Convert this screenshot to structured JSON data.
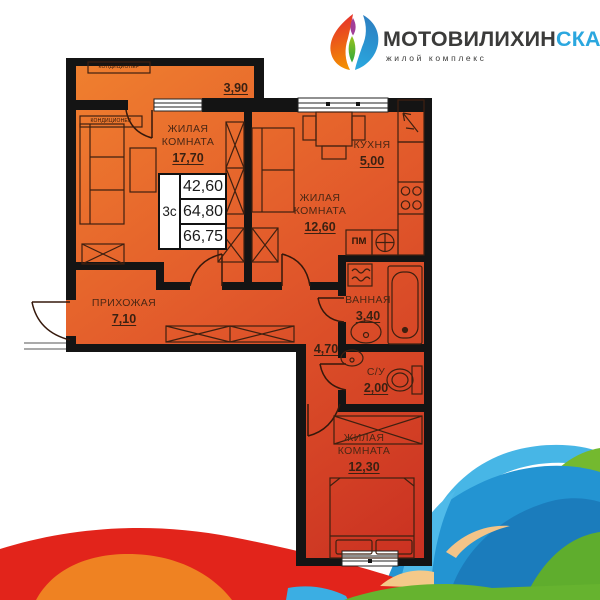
{
  "logo": {
    "brand_main": "МОТОВИЛИХИН",
    "brand_accent": "СКАЙ",
    "tagline": "жилой комплекс",
    "accent_color": "#2ba7df"
  },
  "plan": {
    "apartment_type": "3с",
    "areas": {
      "living": "42,60",
      "total": "64,80",
      "total_with_balcony": "66,75"
    },
    "rooms": [
      {
        "id": "balcony",
        "label": "",
        "area": "3,90"
      },
      {
        "id": "living-room-1",
        "label": "ЖИЛАЯ КОМНАТА",
        "area": "17,70"
      },
      {
        "id": "living-room-2",
        "label": "ЖИЛАЯ КОМНАТА",
        "area": "12,60"
      },
      {
        "id": "kitchen",
        "label": "КУХНЯ",
        "area": "5,00"
      },
      {
        "id": "hallway",
        "label": "ПРИХОЖАЯ",
        "area": "7,10"
      },
      {
        "id": "bathroom",
        "label": "ВАННАЯ",
        "area": "3,40"
      },
      {
        "id": "corridor",
        "label": "",
        "area": "4,70"
      },
      {
        "id": "wc",
        "label": "С/У",
        "area": "2,00"
      },
      {
        "id": "living-room-3",
        "label": "ЖИЛАЯ КОМНАТА",
        "area": "12,30"
      }
    ],
    "annotations": {
      "washing_machine": "ПМ",
      "air_conditioner": "КОНДИЦИОНЕР"
    },
    "colors": {
      "plan_orange": "#f07e33",
      "plan_red": "#c92f21",
      "wall": "#141414",
      "wave_red": "#e2241b",
      "wave_orange": "#ef8222",
      "wave_blue": "#2394d2",
      "wave_light_blue": "#47b6e6",
      "wave_green": "#66b32f",
      "wave_tan": "#f3c488"
    }
  }
}
